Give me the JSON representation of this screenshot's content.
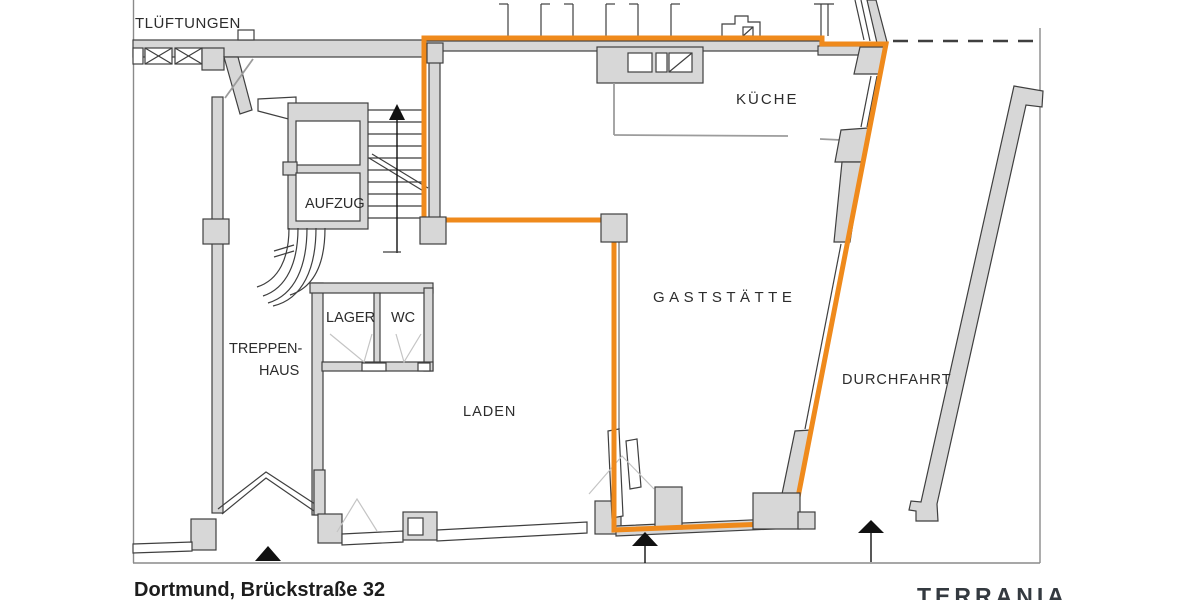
{
  "annotations": {
    "vents": "TLÜFTUNGEN"
  },
  "rooms": {
    "kitchen": "KÜCHE",
    "elevator": "AUFZUG",
    "storage": "LAGER",
    "wc": "WC",
    "stairwell_line1": "TREPPEN-",
    "stairwell_line2": "HAUS",
    "shop": "LADEN",
    "restaurant": "GASTSTÄTTE",
    "passage": "DURCHFAHRT"
  },
  "footer": {
    "address": "Dortmund, Brückstraße 32",
    "subtitle": "Grundriss EG (Teilfläche)",
    "brand": "TERRANIA"
  },
  "colors": {
    "highlight_outline": "#EF8A1C",
    "wall_fill": "#D7D7D7",
    "wall_stroke": "#3F3F3F",
    "brand_text": "#343A40"
  }
}
